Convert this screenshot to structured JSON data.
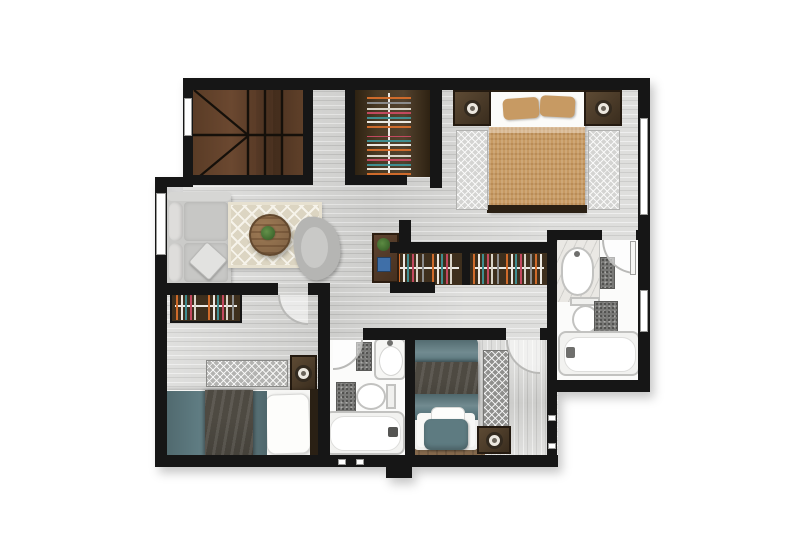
{
  "meta": {
    "title": "Apartment upper floor plan",
    "type": "floor-plan",
    "style": "rendered top-down architectural plan"
  },
  "colors": {
    "wall": "#161616",
    "floor": "#d8d8d6",
    "bathFloor": "#fbfbfa",
    "closetDark": "#3e2f1d",
    "tan": "#c79a63",
    "teal": "#5e7b81",
    "throwDark": "#4e4a42",
    "sofaGray": "#cbcbc9",
    "rugBeige": "#dcd5c2",
    "rugLight": "#d4d4d2",
    "rugMid": "#b3b3b1",
    "rugDark": "#8f8f8d",
    "tableWood": "#8a6a4c",
    "plant": "#3f6b2e",
    "marble": "#eae8e4",
    "matGray": "#787876",
    "laptop": "#3f6fa8",
    "arcGray": "#b9b9b7",
    "bedBase": "#8f7457",
    "headboard": "#2a2014"
  },
  "rooms": {
    "staircase": {
      "name": "Staircase"
    },
    "walk_in_closet": {
      "name": "Walk-in closet"
    },
    "bedroom_main": {
      "name": "Main bedroom"
    },
    "living_room": {
      "name": "Living room"
    },
    "hallway": {
      "name": "Hallway"
    },
    "dressing_closets": {
      "name": "Hallway closets"
    },
    "bathroom_ensuite": {
      "name": "En-suite bathroom"
    },
    "bedroom_2": {
      "name": "Bedroom 2"
    },
    "bathroom_2": {
      "name": "Bathroom"
    },
    "bedroom_3": {
      "name": "Bedroom 3"
    }
  },
  "furniture": {
    "bedroom_main": [
      "double bed",
      "nightstand with lamp x2",
      "runner rug x2"
    ],
    "living_room": [
      "sofa with throw pillow",
      "patterned area rug",
      "round wood coffee table with plant",
      "armchair",
      "desk with laptop and plant"
    ],
    "bedroom_2": [
      "single bed",
      "wardrobe closet",
      "nightstand with lamp",
      "patterned rug"
    ],
    "bedroom_3": [
      "single bed on wood base",
      "nightstand with lamp",
      "runner rug"
    ],
    "bathroom_ensuite": [
      "vanity sink on marble counter",
      "toilet",
      "bathtub",
      "bath mat x2"
    ],
    "bathroom_2": [
      "sink",
      "toilet",
      "bathtub",
      "bath mat x2"
    ]
  }
}
